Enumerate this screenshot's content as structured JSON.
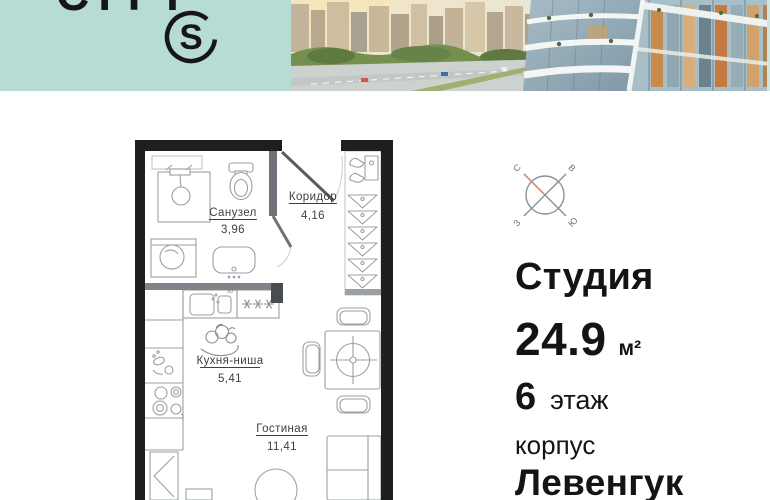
{
  "header": {
    "brand_text": "CITY",
    "logo_letter": "S",
    "brand_color": "#b7dcd3"
  },
  "compass": {
    "north": "С",
    "east": "В",
    "west": "З",
    "south": "Ю",
    "north_color": "#dd8a63"
  },
  "listing": {
    "type": "Студия",
    "area_value": "24.9",
    "area_unit": "м²",
    "floor_value": "6",
    "floor_label": "этаж",
    "building_label": "корпус",
    "building_name": "Левенгук"
  },
  "floor_plan": {
    "rooms": [
      {
        "name": "Санузел",
        "area": "3,96"
      },
      {
        "name": "Коридор",
        "area": "4,16"
      },
      {
        "name": "Кухня-ниша",
        "area": "5,41"
      },
      {
        "name": "Гостиная",
        "area": "11,41"
      }
    ],
    "sink_note": "90°"
  }
}
